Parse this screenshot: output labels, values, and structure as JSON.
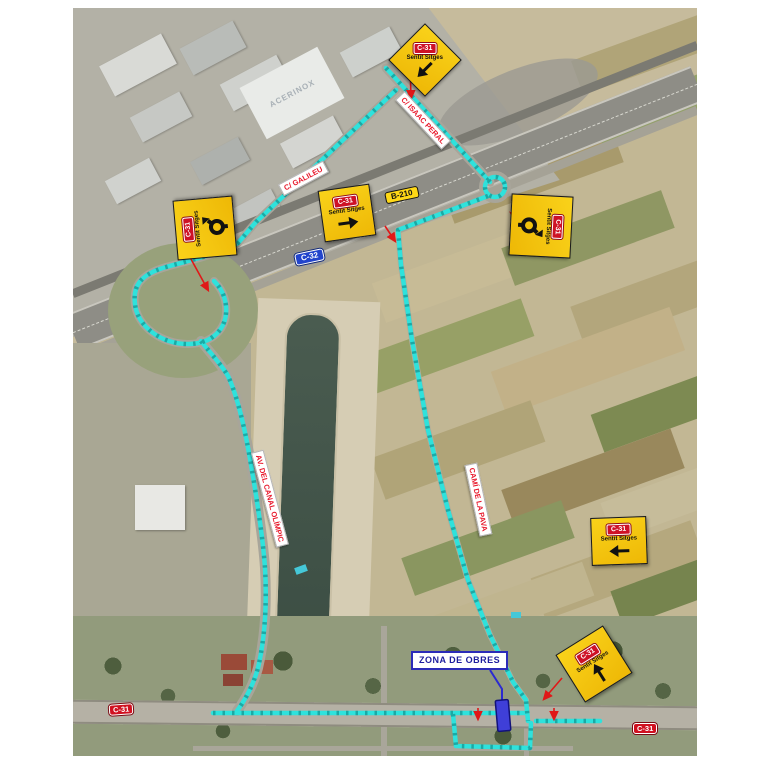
{
  "signs": [
    {
      "id": "top",
      "badge": "C-31",
      "label": "Sentit Sitges",
      "symbol": "arrow-down-left"
    },
    {
      "id": "galileu",
      "badge": "C-31",
      "label": "Sentit Sitges",
      "symbol": "arrow-right"
    },
    {
      "id": "west-roundabout",
      "badge": "C-31",
      "label": "Sentit Sitges",
      "symbol": "roundabout"
    },
    {
      "id": "east-roundabout",
      "badge": "C-31",
      "label": "Sentit Sitges",
      "symbol": "roundabout"
    },
    {
      "id": "east",
      "badge": "C-31",
      "label": "Sentit Sitges",
      "symbol": "arrow-left"
    },
    {
      "id": "southeast",
      "badge": "C-31",
      "label": "Sentit Sitges",
      "symbol": "arrow-up"
    }
  ],
  "street_labels": [
    {
      "id": "isaac-peral",
      "text": "C/ ISAAC PERAL"
    },
    {
      "id": "galileu",
      "text": "C/ GALILEU"
    },
    {
      "id": "canal-olimpic",
      "text": "AV. DEL CANAL OLÍMPIC"
    },
    {
      "id": "cami-pava",
      "text": "CAMÍ DE LA PAVA"
    }
  ],
  "road_badges": [
    {
      "id": "b-210",
      "text": "B-210",
      "style": "yellow"
    },
    {
      "id": "c-32",
      "text": "C-32",
      "style": "blue"
    },
    {
      "id": "c-31-west",
      "text": "C-31",
      "style": "red"
    },
    {
      "id": "c-31-east",
      "text": "C-31",
      "style": "red"
    }
  ],
  "work_zone": {
    "label": "ZONA DE OBRES"
  },
  "landmarks": {
    "warehouse_roof_text": "ACERINOX"
  },
  "colors": {
    "detour_route": "#2FE2DC",
    "sign_yellow": "#F6C60C",
    "badge_red": "#CE1126",
    "c32_blue": "#2244CC",
    "work_zone_blue": "#2B2BD0"
  }
}
